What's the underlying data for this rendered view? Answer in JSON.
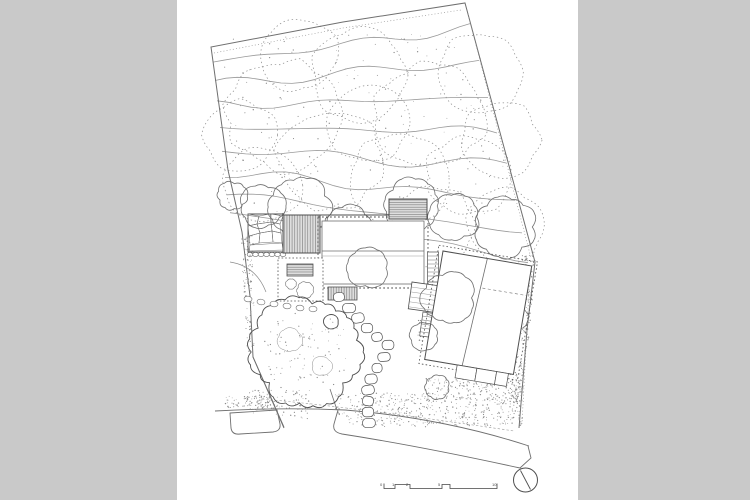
{
  "colors": {
    "background": "#c9c9c9",
    "paper": "#ffffff",
    "ink": "#4f4f4f",
    "ink_soft": "#6f6f6f",
    "ink_light": "#9a9a9a",
    "hatch_fill": "#dedede",
    "stipple": "#8c8c8c"
  },
  "scale_bar": {
    "labels": [
      "0",
      "1",
      "2",
      "5",
      "10"
    ]
  },
  "north_arrow": {
    "icon": "north-arrow-icon"
  }
}
